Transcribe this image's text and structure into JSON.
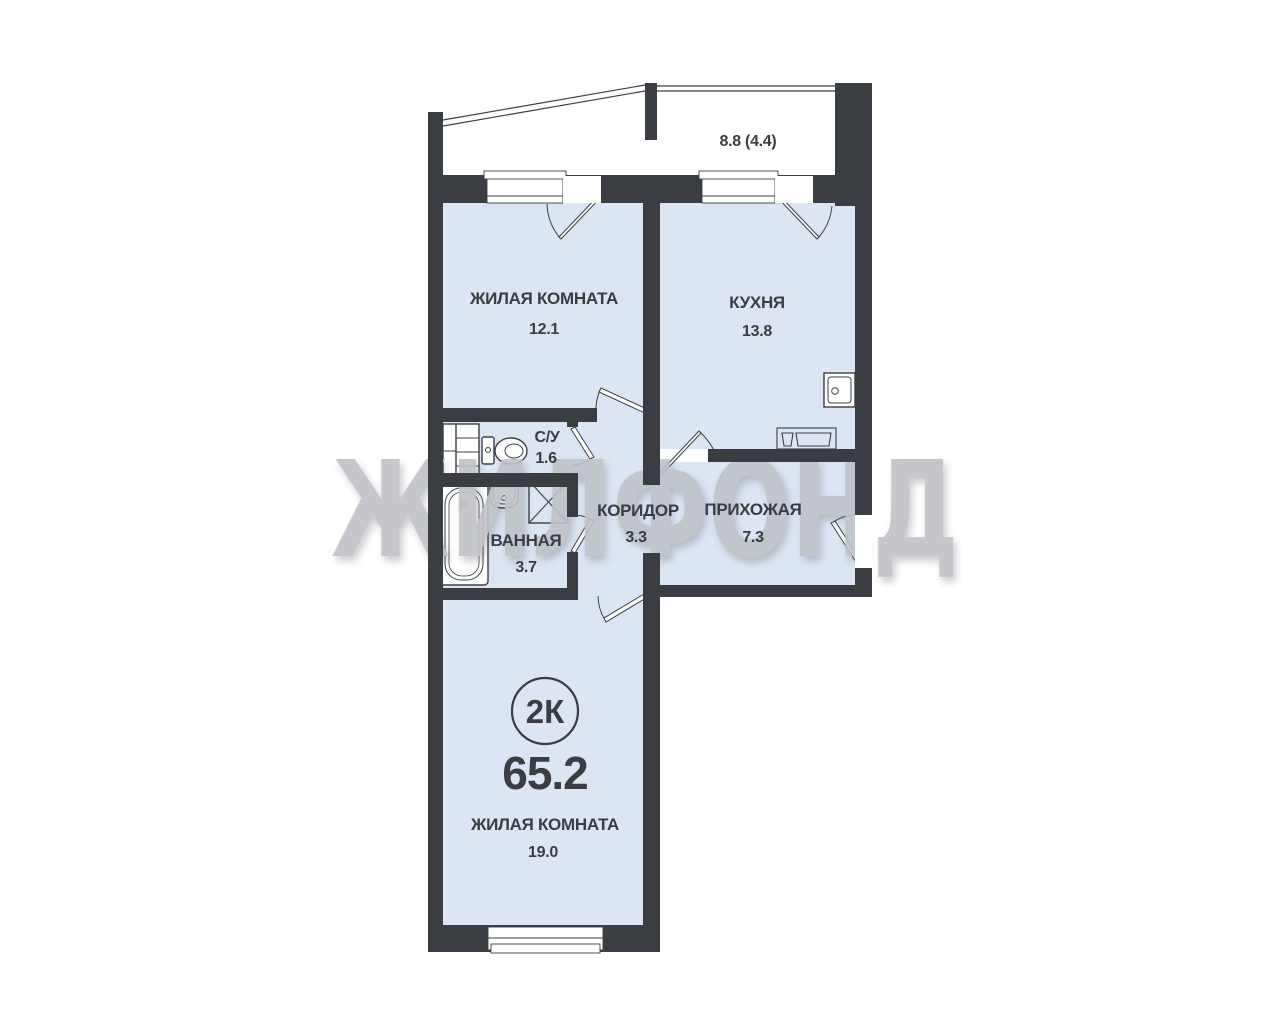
{
  "plan": {
    "title_badge": "2К",
    "total_area": "65.2",
    "balcony": {
      "area_label": "8.8 (4.4)"
    },
    "rooms": [
      {
        "name": "ЖИЛАЯ КОМНАТА",
        "area": "12.1"
      },
      {
        "name": "КУХНЯ",
        "area": "13.8"
      },
      {
        "name": "С/У",
        "area": "1.6"
      },
      {
        "name": "ВАННАЯ",
        "area": "3.7"
      },
      {
        "name": "КОРИДОР",
        "area": "3.3"
      },
      {
        "name": "ПРИХОЖАЯ",
        "area": "7.3"
      },
      {
        "name": "ЖИЛАЯ КОМНАТА",
        "area": "19.0"
      }
    ],
    "watermark": "ЖИЛФОНД",
    "colors": {
      "wall": "#3a3d42",
      "room_fill": "#dbe5f3",
      "fixture_fill": "#ffffff",
      "watermark_gray": "#bfc2c8"
    }
  }
}
